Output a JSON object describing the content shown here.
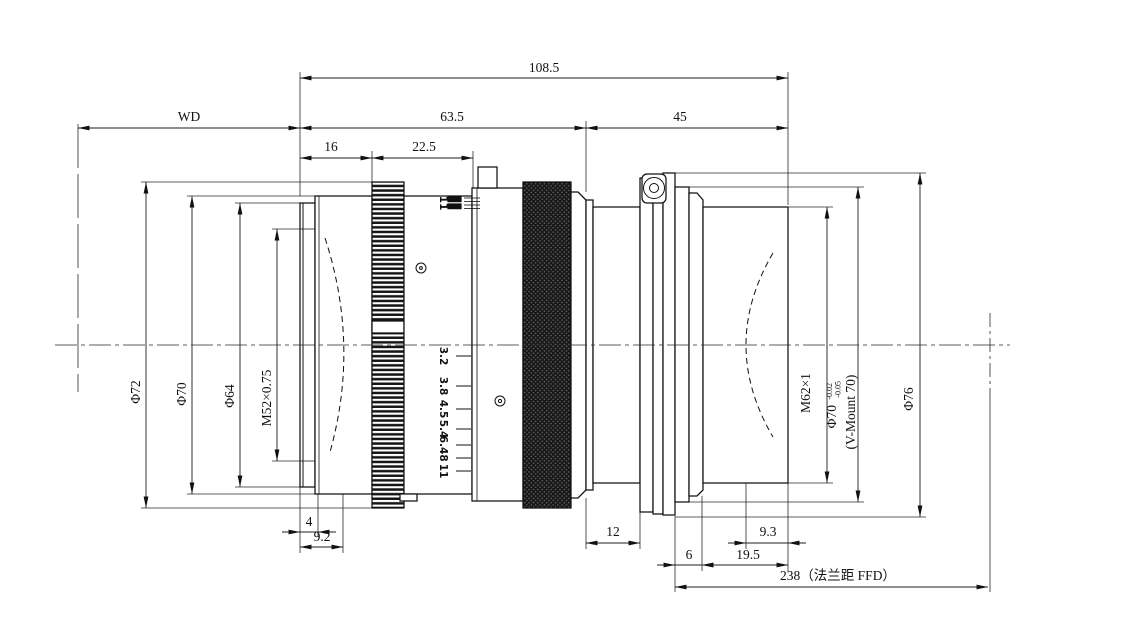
{
  "dims": {
    "overall": "108.5",
    "wd": "WD",
    "front_module": "63.5",
    "rear_module": "45",
    "seg16": "16",
    "seg22_5": "22.5",
    "d4": "4",
    "d9_2": "9.2",
    "d12": "12",
    "d6": "6",
    "d19_5": "19.5",
    "d9_3": "9.3",
    "ffd": "238（法兰距 FFD）"
  },
  "dias": {
    "phi72": "Φ72",
    "phi70": "Φ70",
    "phi64": "Φ64",
    "m52": "M52×0.75",
    "m62": "M62×1",
    "phi70v": "Φ70",
    "phi70v_tol_up": "-0.02",
    "phi70v_tol_dn": "-0.05",
    "vmount": "(V-Mount 70)",
    "phi76": "Φ76"
  },
  "aperture_scale": [
    "3.2",
    "3.8",
    "4.5",
    "5.4",
    "6.4",
    "8",
    "11"
  ],
  "top_mark": "11"
}
